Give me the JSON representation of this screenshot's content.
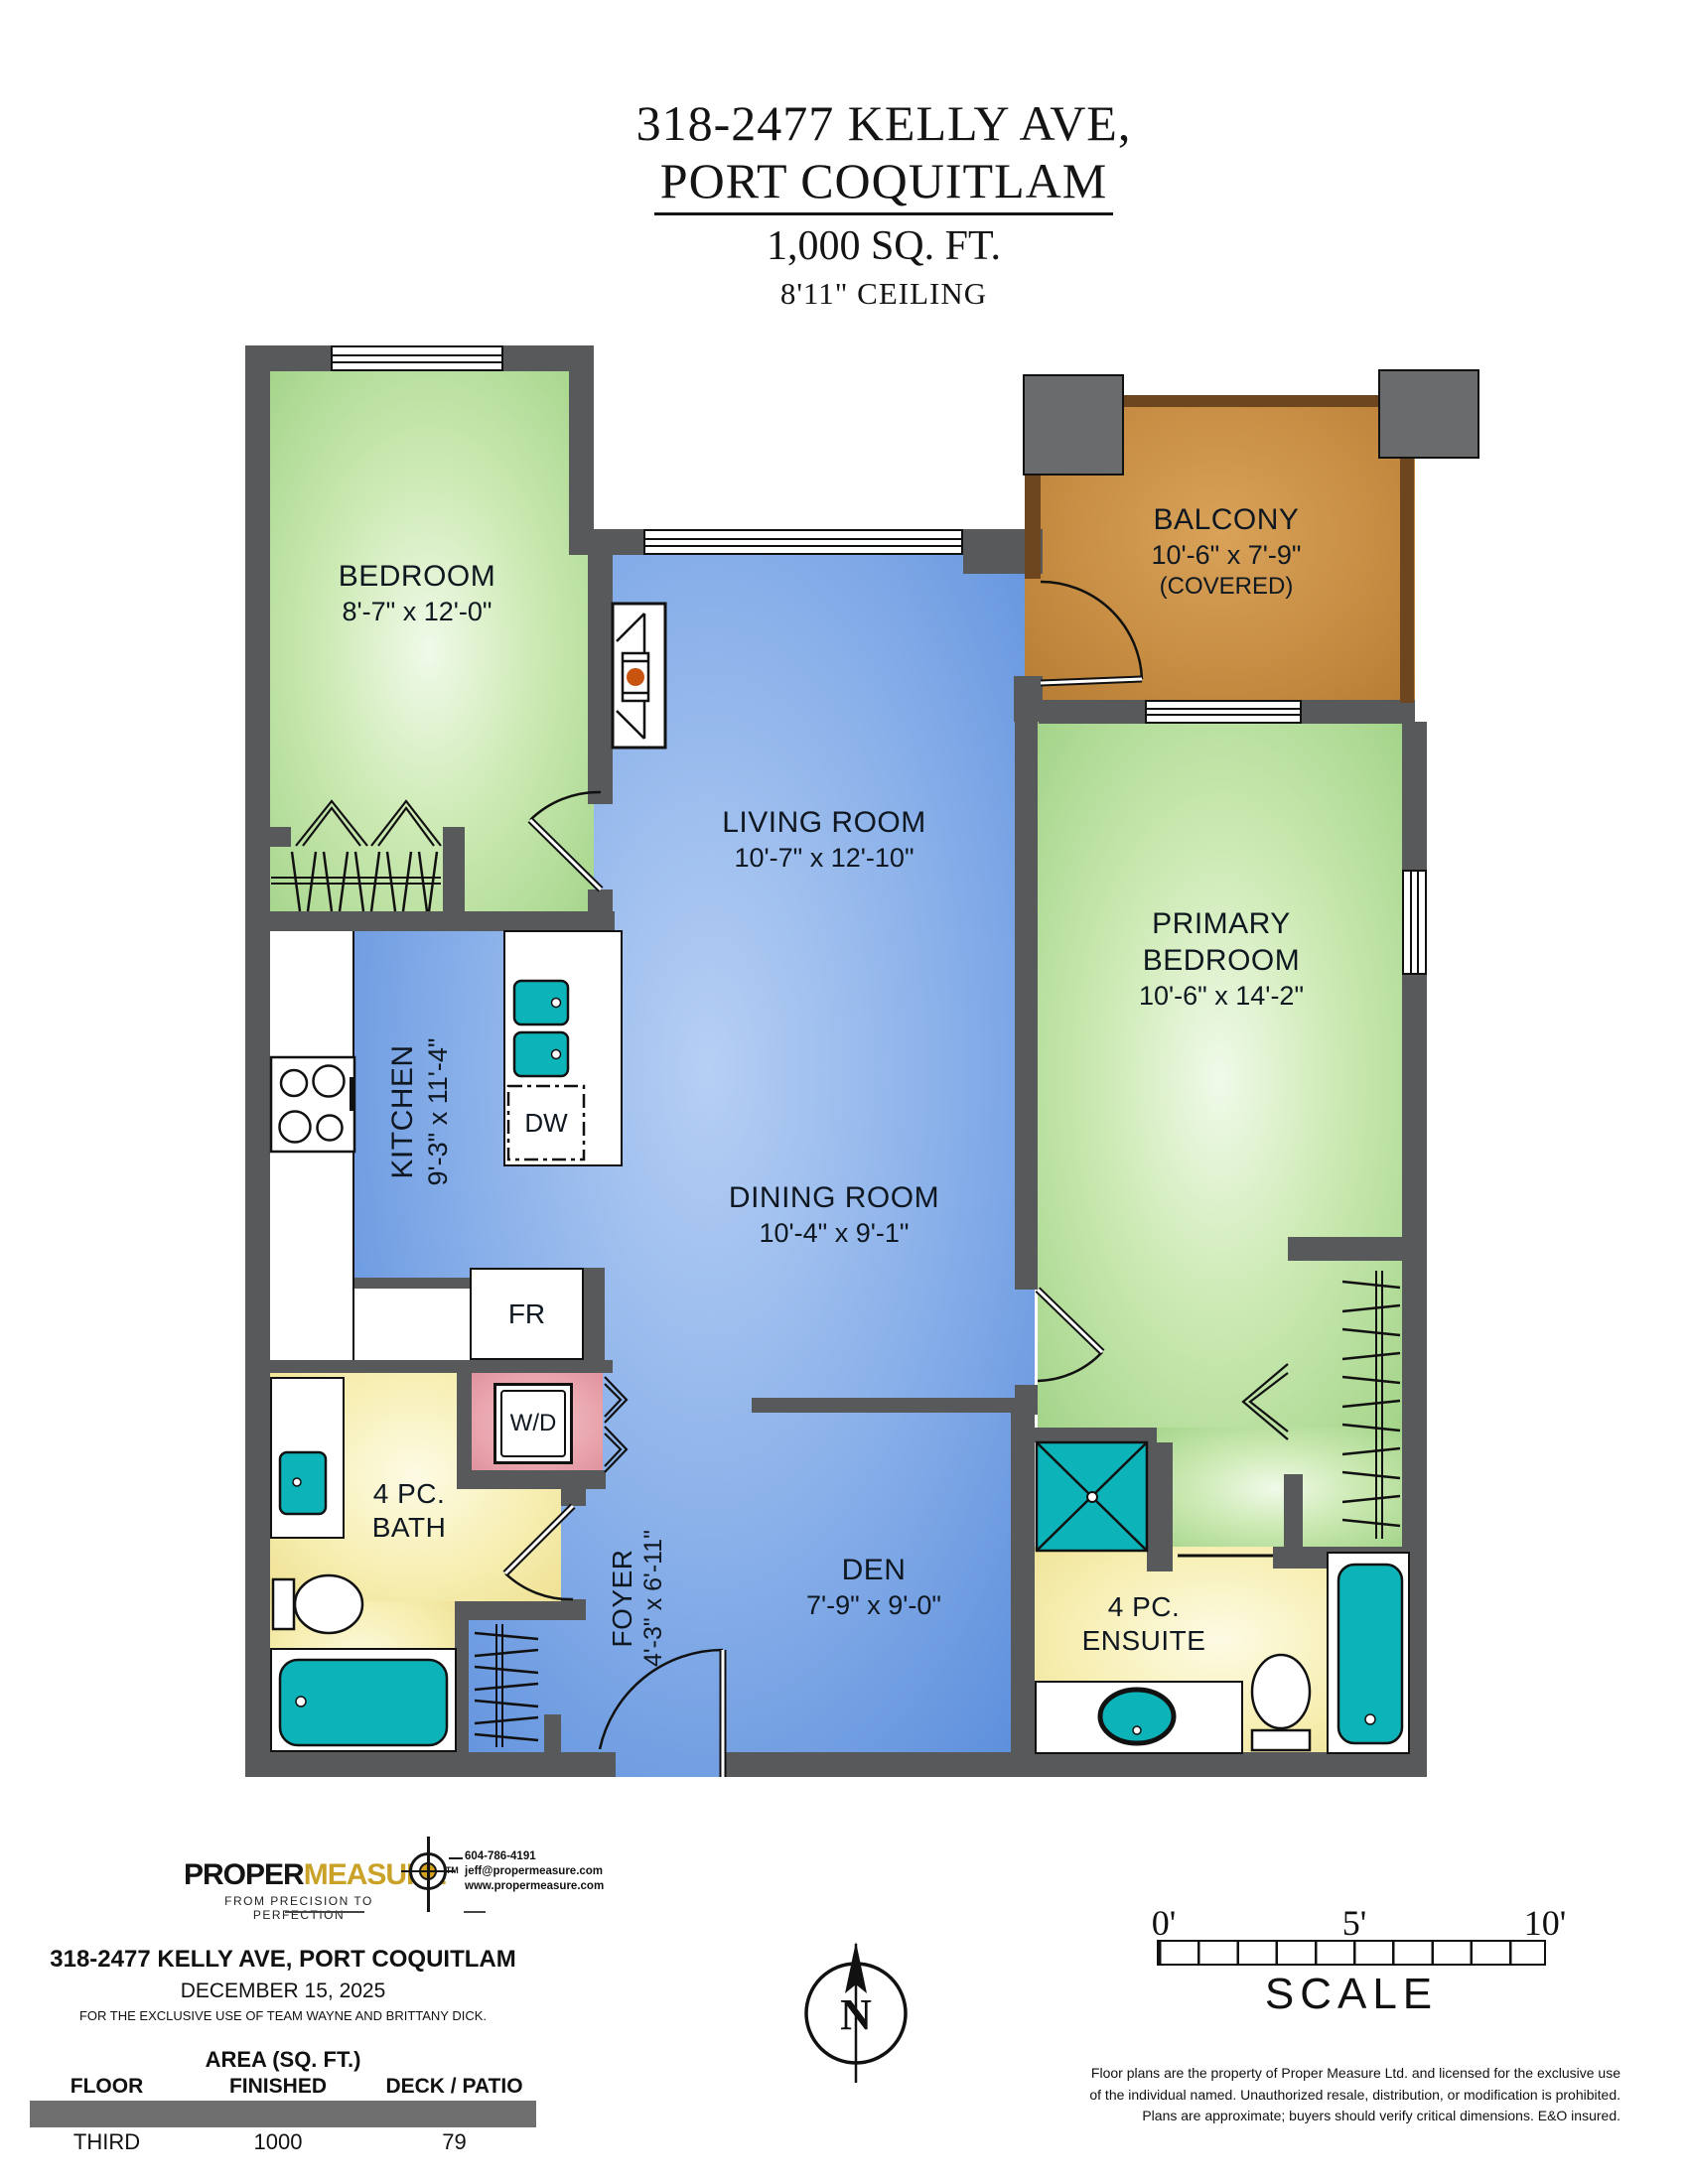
{
  "title": {
    "line1": "318-2477 KELLY AVE,",
    "line2": "PORT COQUITLAM",
    "line3": "1,000 SQ. FT.",
    "line4": "8'11\" CEILING"
  },
  "rooms": {
    "bedroom": {
      "name": "BEDROOM",
      "dims": "8'-7\" x 12'-0\""
    },
    "living_room": {
      "name": "LIVING ROOM",
      "dims": "10'-7\" x 12'-10\""
    },
    "balcony": {
      "name": "BALCONY",
      "dims": "10'-6\" x 7'-9\"",
      "note": "(COVERED)"
    },
    "primary_bedroom": {
      "line1": "PRIMARY",
      "line2": "BEDROOM",
      "dims": "10'-6\" x 14'-2\""
    },
    "kitchen": {
      "name": "KITCHEN",
      "dims": "9'-3\" x 11'-4\""
    },
    "dining_room": {
      "name": "DINING ROOM",
      "dims": "10'-4\" x 9'-1\""
    },
    "den": {
      "name": "DEN",
      "dims": "7'-9\" x 9'-0\""
    },
    "foyer": {
      "name": "FOYER",
      "dims": "4'-3\" x 6'-11\""
    },
    "bath": {
      "line1": "4 PC.",
      "line2": "BATH"
    },
    "ensuite": {
      "line1": "4 PC.",
      "line2": "ENSUITE"
    }
  },
  "appliances": {
    "dishwasher": "DW",
    "fridge": "FR",
    "washer_dryer": "W/D"
  },
  "logo": {
    "brand_part1": "PROPER",
    "brand_part2": "MEASURE",
    "tm": "TM",
    "tagline": "FROM PRECISION TO PERFECTION",
    "phone": "604-786-4191",
    "email": "jeff@propermeasure.com",
    "website": "www.propermeasure.com"
  },
  "footer": {
    "address": "318-2477 KELLY AVE, PORT COQUITLAM",
    "date": "DECEMBER 15, 2025",
    "exclusive": "FOR THE EXCLUSIVE USE OF TEAM WAYNE AND BRITTANY DICK.",
    "table": {
      "title": "AREA (SQ. FT.)",
      "headers": [
        "FLOOR",
        "FINISHED",
        "DECK / PATIO"
      ],
      "rows": [
        [
          "THIRD",
          "1000",
          "79"
        ]
      ]
    },
    "disclaimer_lines": [
      "Floor plans are the property of Proper Measure Ltd. and licensed for the exclusive use",
      "of the individual named. Unauthorized resale, distribution, or modification is prohibited.",
      "Plans are approximate; buyers should verify critical dimensions. E&O insured."
    ]
  },
  "compass": {
    "label": "N"
  },
  "scale_bar": {
    "ticks": [
      "0'",
      "5'",
      "10'"
    ],
    "label": "SCALE"
  },
  "colors": {
    "wall": "#58595b",
    "pillar": "#6a6b6d",
    "bedroom_floor": "#b7e19c",
    "living_floor": "#7fa9e6",
    "balcony_floor": "#c4873f",
    "bath_floor": "#f5eca6",
    "closet_pink": "#e9a6ae",
    "fixture_teal": "#0cb4b9",
    "logo_gold": "#c9a227"
  }
}
